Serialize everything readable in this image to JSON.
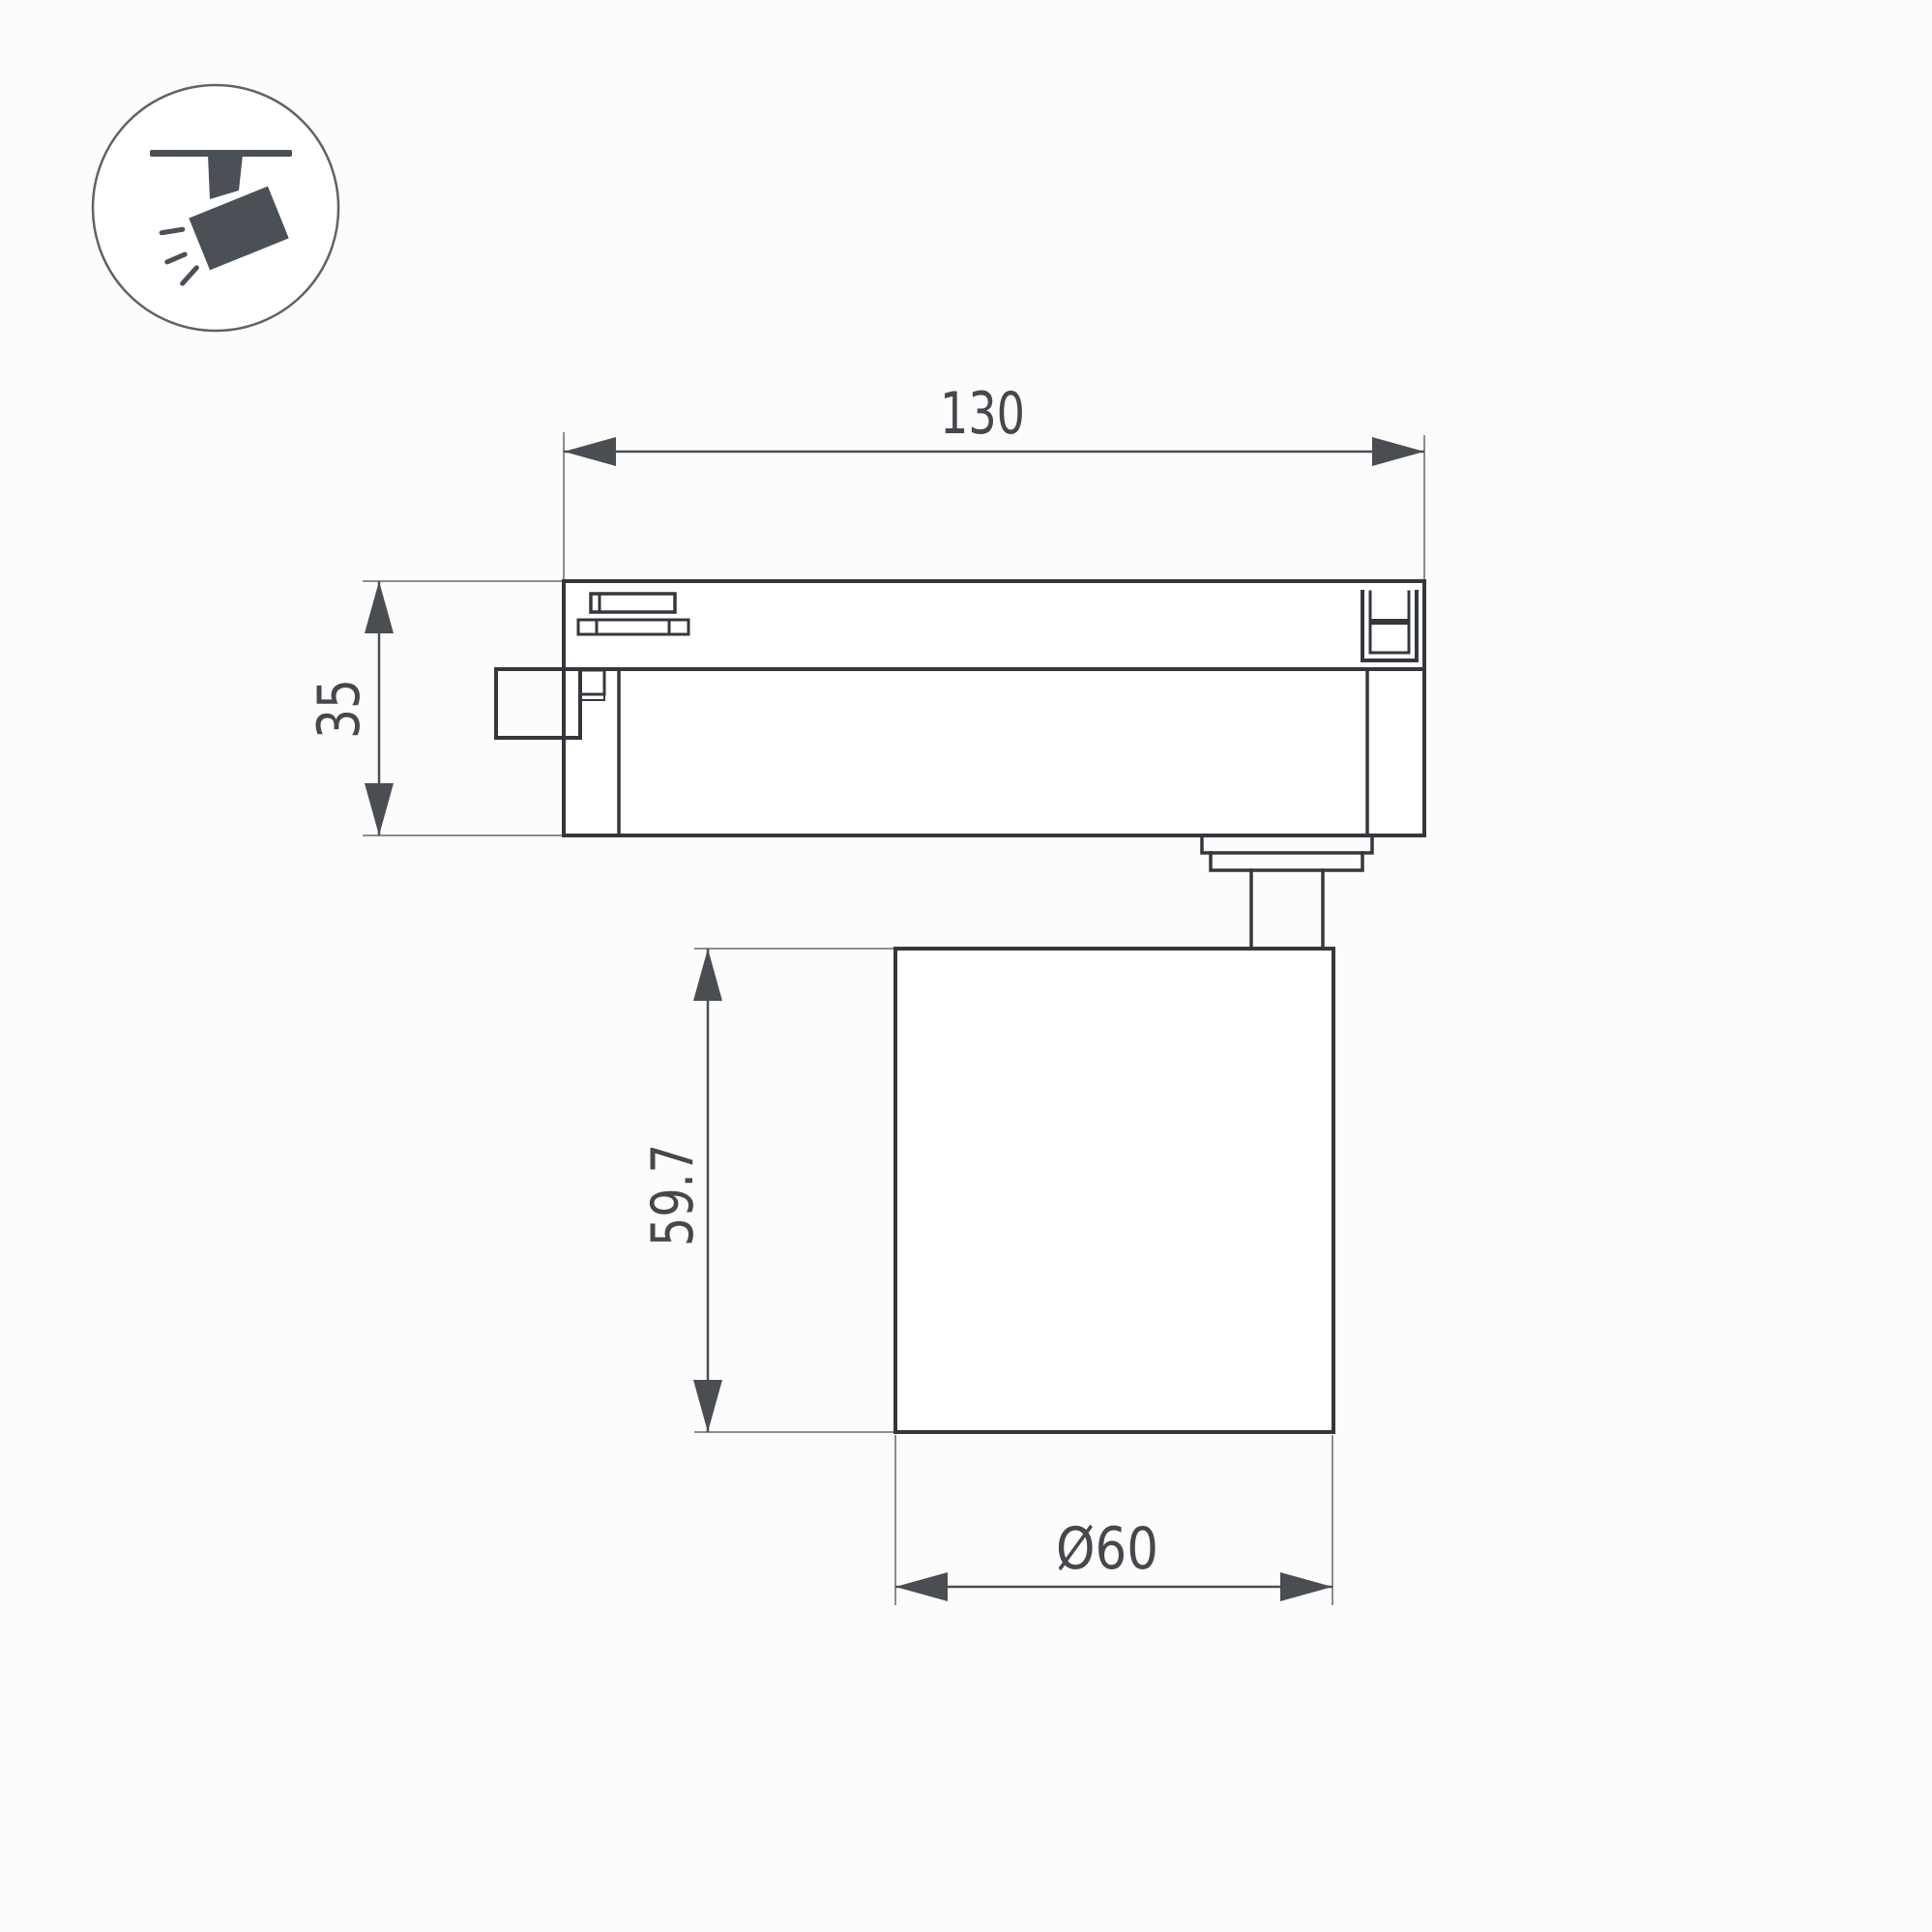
{
  "page": {
    "background_color": "#fcfcfc",
    "kind": "product dimensional drawing of a track spotlight"
  },
  "icon_badge": {
    "icon": "track-spotlight-icon",
    "glyph_color": "#4a5056",
    "circle_color": "#5f6367"
  },
  "drawing": {
    "colors": {
      "object_line": "#34383c",
      "dimension_line": "#4a4e52",
      "extension_line": "#8b8e90",
      "text": "#45484c"
    },
    "dimensions": {
      "track_width": "130",
      "adapter_height": "35",
      "body_height": "59.7",
      "body_diameter": "Ø60"
    }
  }
}
